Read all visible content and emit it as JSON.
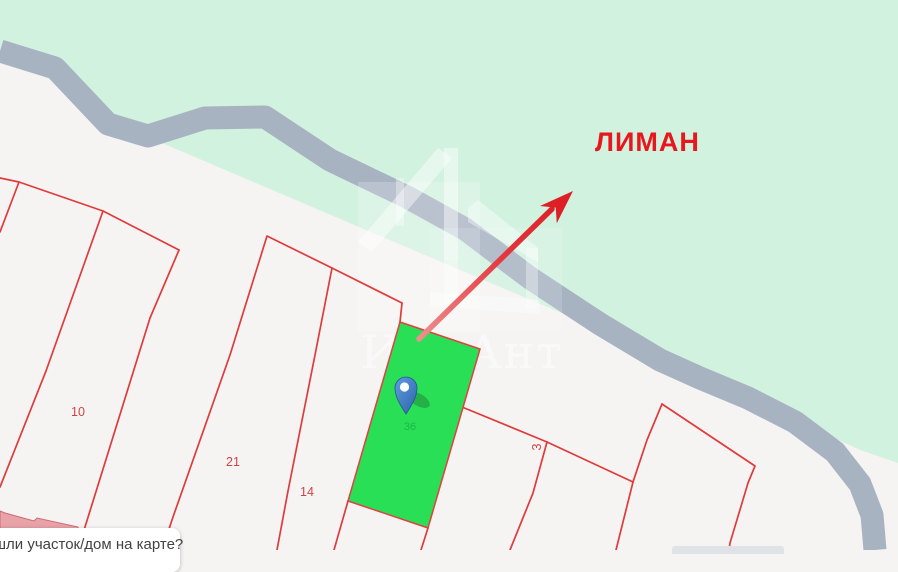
{
  "map": {
    "region_label": "ЛИМАН",
    "watermark": "ИриАнт",
    "selected_parcel_number": "36",
    "parcels": [
      {
        "number": "10"
      },
      {
        "number": "21"
      },
      {
        "number": "14"
      },
      {
        "number": "3"
      }
    ],
    "tooltip_text": "шли участок/дом на карте?",
    "colors": {
      "water_green": "#d2f2e0",
      "road_gray": "#a8b3c2",
      "land_white": "#f5f4f3",
      "parcel_line_red": "#df3b3b",
      "selected_parcel_green": "#29df56",
      "label_red": "#e8161d",
      "arrow_red": "#dd1f26",
      "pin_blue": "#3a7cc7",
      "building_pink": "#e7a3a8"
    }
  }
}
